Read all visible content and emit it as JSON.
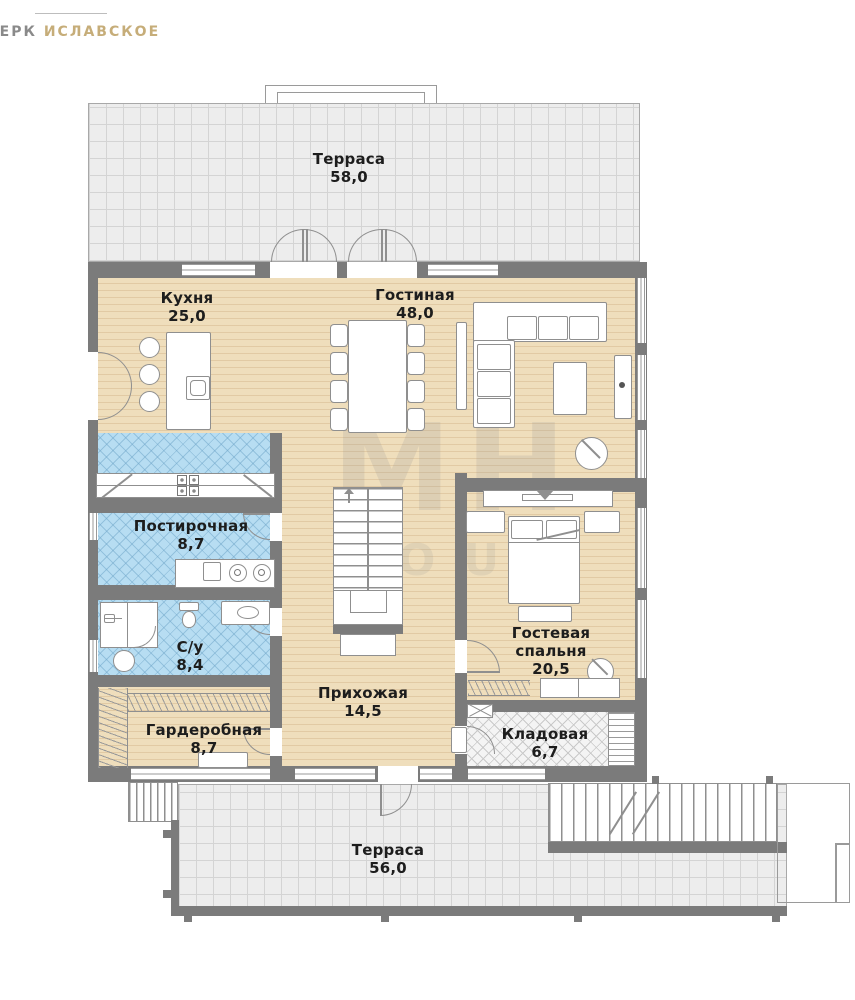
{
  "logo": {
    "brand": "ВЕРК",
    "location": "ИСЛАВСКОЕ"
  },
  "watermark": {
    "line1": "МН",
    "line2": "OUP"
  },
  "colors": {
    "wall": "#7b7b7b",
    "wood_floor": "#efdebc",
    "tile_blue": "#b7ddf2",
    "terrace_tile": "#ededed",
    "storage_floor": "#f4f4f4",
    "label_text": "#1d1d1d",
    "logo_gold": "#c6ad79",
    "logo_gray": "#8a8a8a"
  },
  "rooms": [
    {
      "id": "terrace-top",
      "name": "Терраса",
      "area": "58,0"
    },
    {
      "id": "kitchen",
      "name": "Кухня",
      "area": "25,0"
    },
    {
      "id": "living-room",
      "name": "Гостиная",
      "area": "48,0"
    },
    {
      "id": "laundry",
      "name": "Постирочная",
      "area": "8,7"
    },
    {
      "id": "bathroom",
      "name": "С/у",
      "area": "8,4"
    },
    {
      "id": "wardrobe",
      "name": "Гардеробная",
      "area": "8,7"
    },
    {
      "id": "hallway",
      "name": "Прихожая",
      "area": "14,5"
    },
    {
      "id": "guest-bedroom",
      "name": "Гостевая",
      "name2": "спальня",
      "area": "20,5",
      "full_name": "Гостевая спальня"
    },
    {
      "id": "storage",
      "name": "Кладовая",
      "area": "6,7"
    },
    {
      "id": "terrace-bottom",
      "name": "Терраса",
      "area": "56,0"
    }
  ]
}
